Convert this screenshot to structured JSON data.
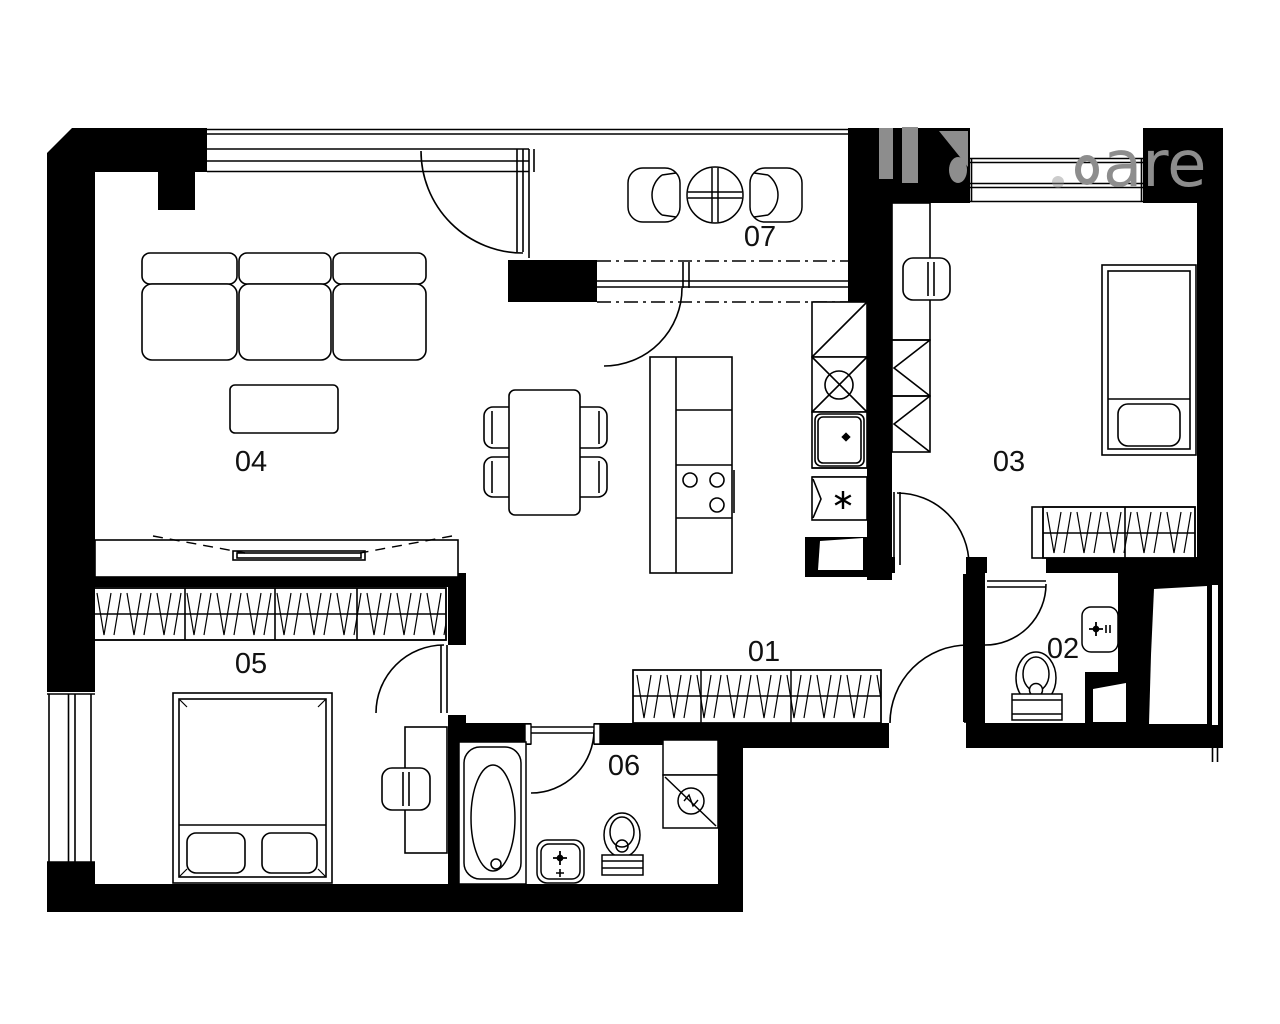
{
  "floor_plan": {
    "labels": {
      "r01": "01",
      "r02": "02",
      "r03": "03",
      "r04": "04",
      "r05": "05",
      "r06": "06",
      "r07": "07"
    },
    "watermark": {
      "fragment": "are",
      "color": "#8d8d8d"
    },
    "colors": {
      "walls": "#000000",
      "lines": "#000000",
      "background": "#ffffff"
    },
    "fixtures": [
      "sofa",
      "coffee-table",
      "tv-sideboard",
      "dining-table-with-chairs",
      "kitchen-island-cooktop",
      "kitchen-counter-sink",
      "dishwasher-asterisk",
      "balcony-round-table-chairs",
      "single-bed",
      "double-bed",
      "desk-chair",
      "wardrobe-hatched",
      "bathtub",
      "washbasin",
      "toilet",
      "washing-machine"
    ]
  }
}
